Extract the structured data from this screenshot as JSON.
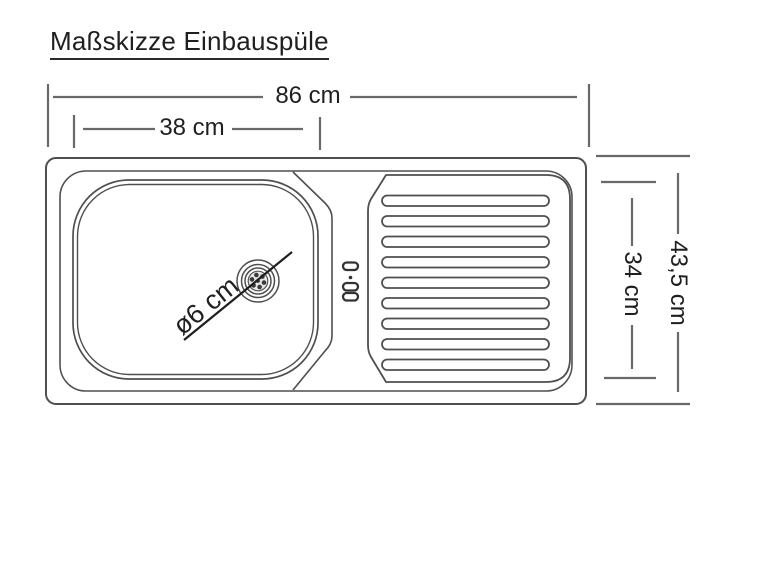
{
  "title": "Maßskizze Einbauspüle",
  "diagram": {
    "type": "technical-dimension-sketch",
    "dimensions": {
      "total_width": {
        "label": "86 cm",
        "value_cm": 86
      },
      "basin_width": {
        "label": "38 cm",
        "value_cm": 38
      },
      "total_depth": {
        "label": "43,5 cm",
        "value_cm": 43.5
      },
      "inner_depth": {
        "label": "34 cm",
        "value_cm": 34
      },
      "drain_diameter": {
        "label": "ø6 cm",
        "value_cm": 6
      }
    },
    "colors": {
      "background": "#ffffff",
      "outline": "#4f4f4f",
      "dimension_line": "#696969",
      "text": "#1f1f1f"
    }
  }
}
